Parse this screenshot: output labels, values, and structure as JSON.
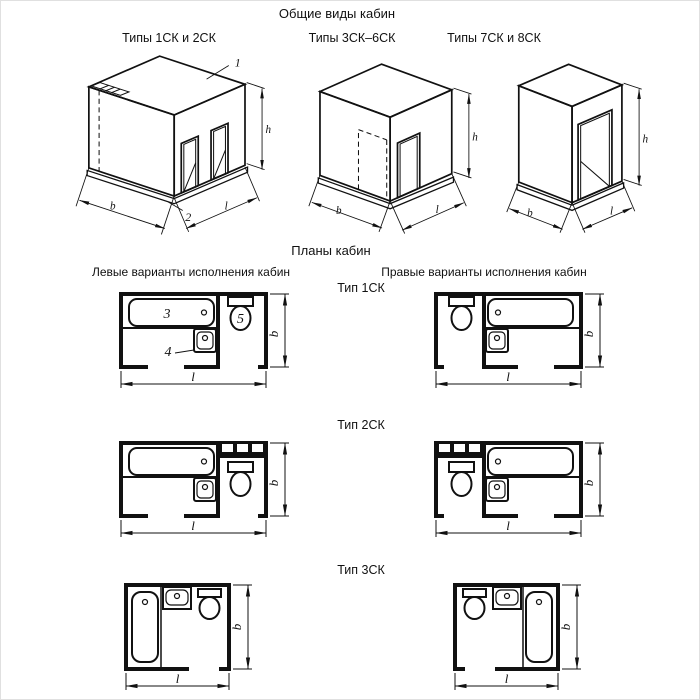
{
  "colors": {
    "ink": "#111111",
    "background": "#ffffff"
  },
  "header": {
    "title": "Общие виды кабин"
  },
  "sections": {
    "plans_title": "Планы кабин",
    "left_header": "Левые варианты исполнения кабин",
    "right_header": "Правые варианты исполнения кабин"
  },
  "iso_titles": {
    "t12": "Типы 1СК и 2СК",
    "t36": "Типы 3СК–6СК",
    "t78": "Типы 7СК и 8СК"
  },
  "type_labels": {
    "t1": "Тип 1СК",
    "t2": "Тип 2СК",
    "t3": "Тип 3СК"
  },
  "dim_labels": {
    "b": "b",
    "l": "l",
    "h": "h"
  },
  "callouts": {
    "c1": "1",
    "c2": "2",
    "c3": "3",
    "c4": "4",
    "c5": "5"
  }
}
